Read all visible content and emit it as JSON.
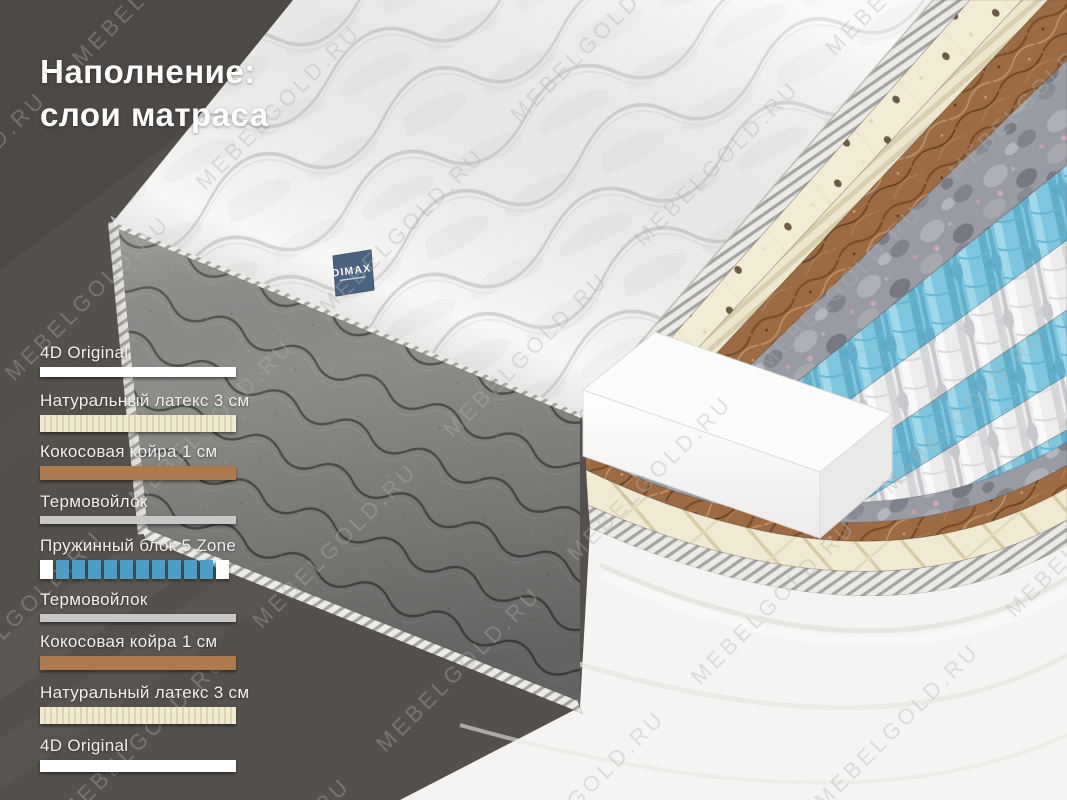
{
  "title": {
    "line1": "Наполнение:",
    "line2": "слои матраса"
  },
  "watermark": "MEBELGOLD.RU",
  "brand": "DIMAX",
  "layer_labels": [
    {
      "label": "4D Original",
      "type": "cover"
    },
    {
      "label": "Натуральный латекс 3 см",
      "type": "latex"
    },
    {
      "label": "Кокосовая койра 1 см",
      "type": "coir"
    },
    {
      "label": "Термовойлок",
      "type": "felt"
    },
    {
      "label": "Пружинный блок 5 Zone",
      "type": "springs",
      "squares": [
        "#ffffff",
        "#4f9dc2",
        "#4f9dc2",
        "#4f9dc2",
        "#4f9dc2",
        "#4f9dc2",
        "#4f9dc2",
        "#4f9dc2",
        "#4f9dc2",
        "#4f9dc2",
        "#4f9dc2",
        "#ffffff"
      ]
    },
    {
      "label": "Термовойлок",
      "type": "felt"
    },
    {
      "label": "Кокосовая койра 1 см",
      "type": "coir"
    },
    {
      "label": "Натуральный латекс 3 см",
      "type": "latex"
    },
    {
      "label": "4D Original",
      "type": "cover"
    }
  ],
  "colors": {
    "background": "#54504d",
    "swatch_cover": "#ffffff",
    "swatch_latex": "#f1ebd3",
    "swatch_latex_rib": "#ddd4b3",
    "swatch_coir": "#ad7a50",
    "swatch_felt": "#c9c8c6",
    "spring_blue": "#4f9dc2",
    "spring_white": "#f2f2f2",
    "tag": "#4b6280"
  }
}
